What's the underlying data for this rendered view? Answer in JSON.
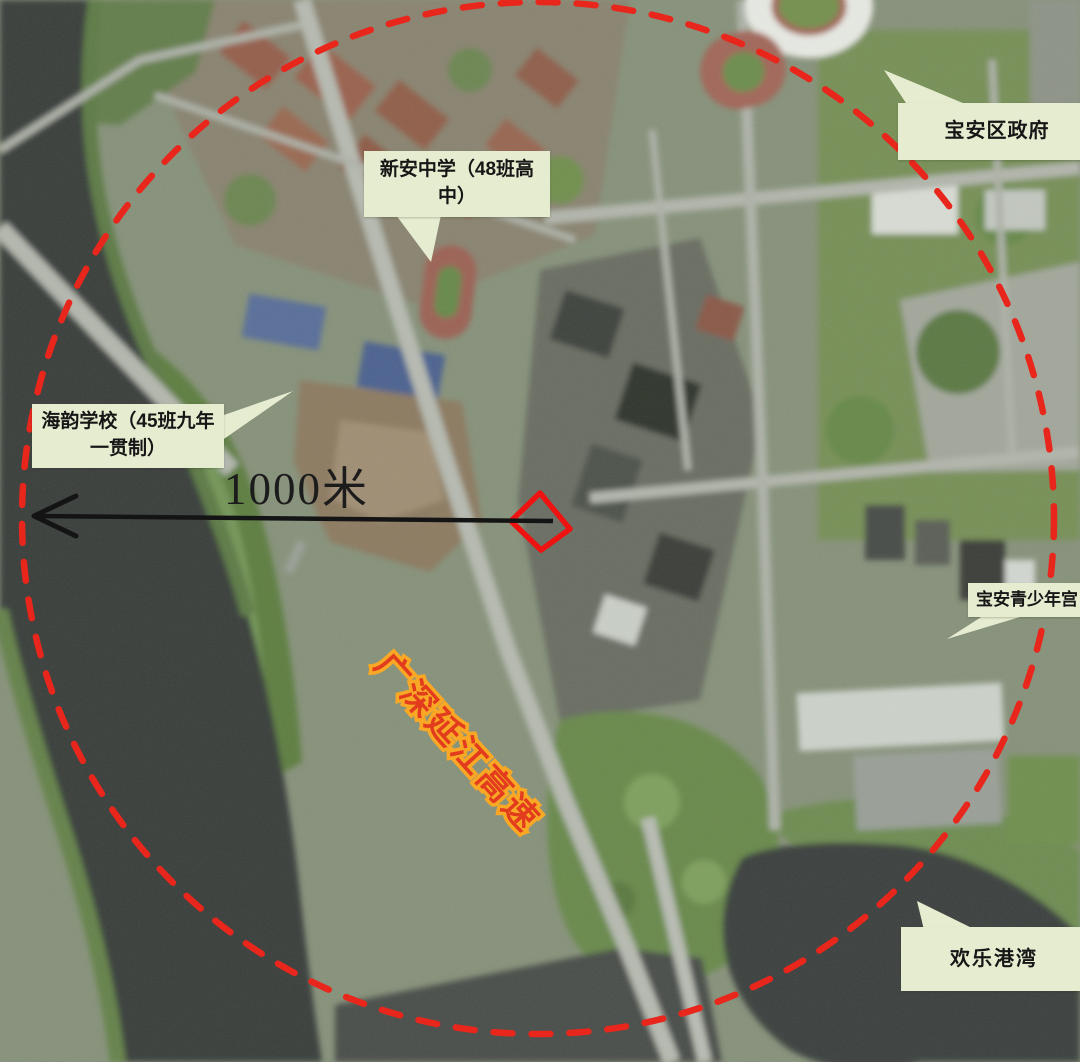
{
  "map": {
    "scale_label": "1000米",
    "highway": {
      "text": "广深延江高速",
      "fill_color": "#e23b1e",
      "outline_color": "#f9a825"
    },
    "radius_circle_color": "#e8261c",
    "site_outline_color": "#ee1310",
    "callout_bg": "#e6ecd0",
    "callouts": [
      {
        "id": "xinan-middle-school",
        "label": "新安中学（48班高中）"
      },
      {
        "id": "baoan-district-government",
        "label": "宝安区政府"
      },
      {
        "id": "haiyun-school",
        "label": "海韵学校（45班九年一贯制）"
      },
      {
        "id": "baoan-youth-palace",
        "label": "宝安青少年宫"
      },
      {
        "id": "oh-bay",
        "label": "欢乐港湾"
      }
    ]
  }
}
